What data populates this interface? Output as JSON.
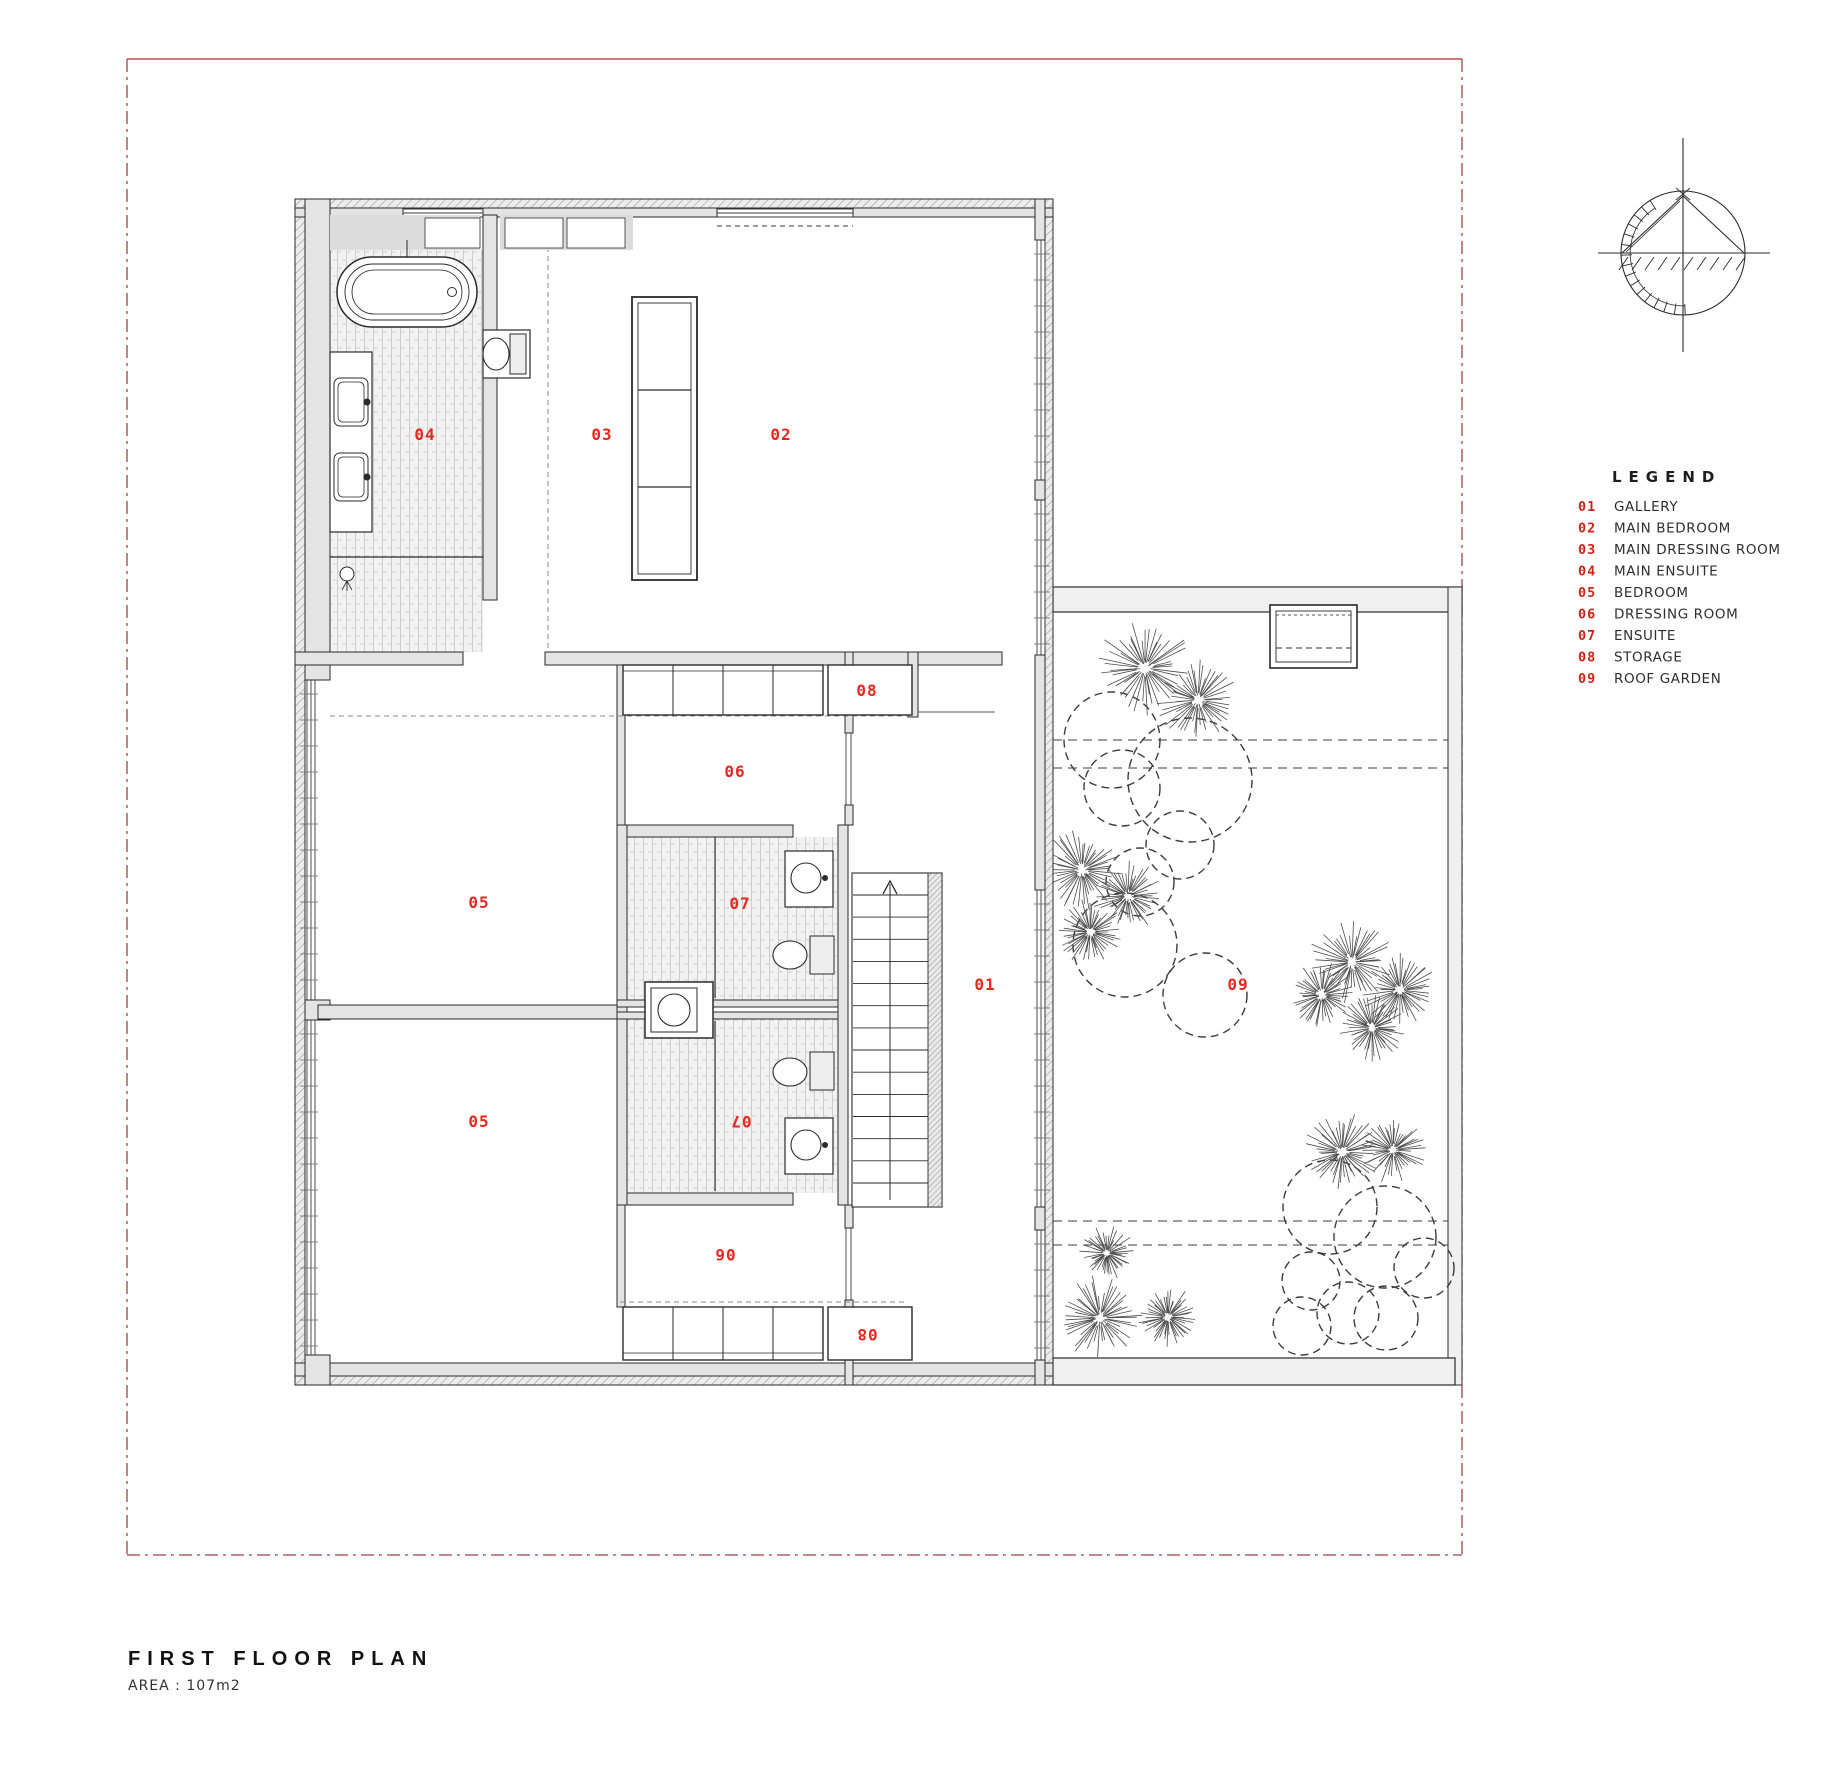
{
  "colors": {
    "label_red": "#e8281e",
    "legend_num_red": "#cc2418",
    "boundary_red": "#9e4343",
    "boundary_top_red": "#c24b4b",
    "wall_fill": "#e4e4e4",
    "line_dark": "#2a2a2a"
  },
  "title_block": {
    "title": "FIRST FLOOR PLAN",
    "area_label": "AREA : 107m2"
  },
  "legend": {
    "title": "LEGEND",
    "items": [
      {
        "num": "01",
        "label": "GALLERY"
      },
      {
        "num": "02",
        "label": "MAIN BEDROOM"
      },
      {
        "num": "03",
        "label": "MAIN DRESSING ROOM"
      },
      {
        "num": "04",
        "label": "MAIN ENSUITE"
      },
      {
        "num": "05",
        "label": "BEDROOM"
      },
      {
        "num": "06",
        "label": "DRESSING ROOM"
      },
      {
        "num": "07",
        "label": "ENSUITE"
      },
      {
        "num": "08",
        "label": "STORAGE"
      },
      {
        "num": "09",
        "label": "ROOF GARDEN"
      }
    ]
  },
  "plan": {
    "room_numbers": {
      "r01": "01",
      "r02": "02",
      "r03": "03",
      "r04": "04",
      "r05": "05",
      "r06": "06",
      "r07": "07",
      "r08": "08",
      "r09": "09"
    }
  },
  "icons": {
    "north_symbol": "north-arrow-compass"
  }
}
